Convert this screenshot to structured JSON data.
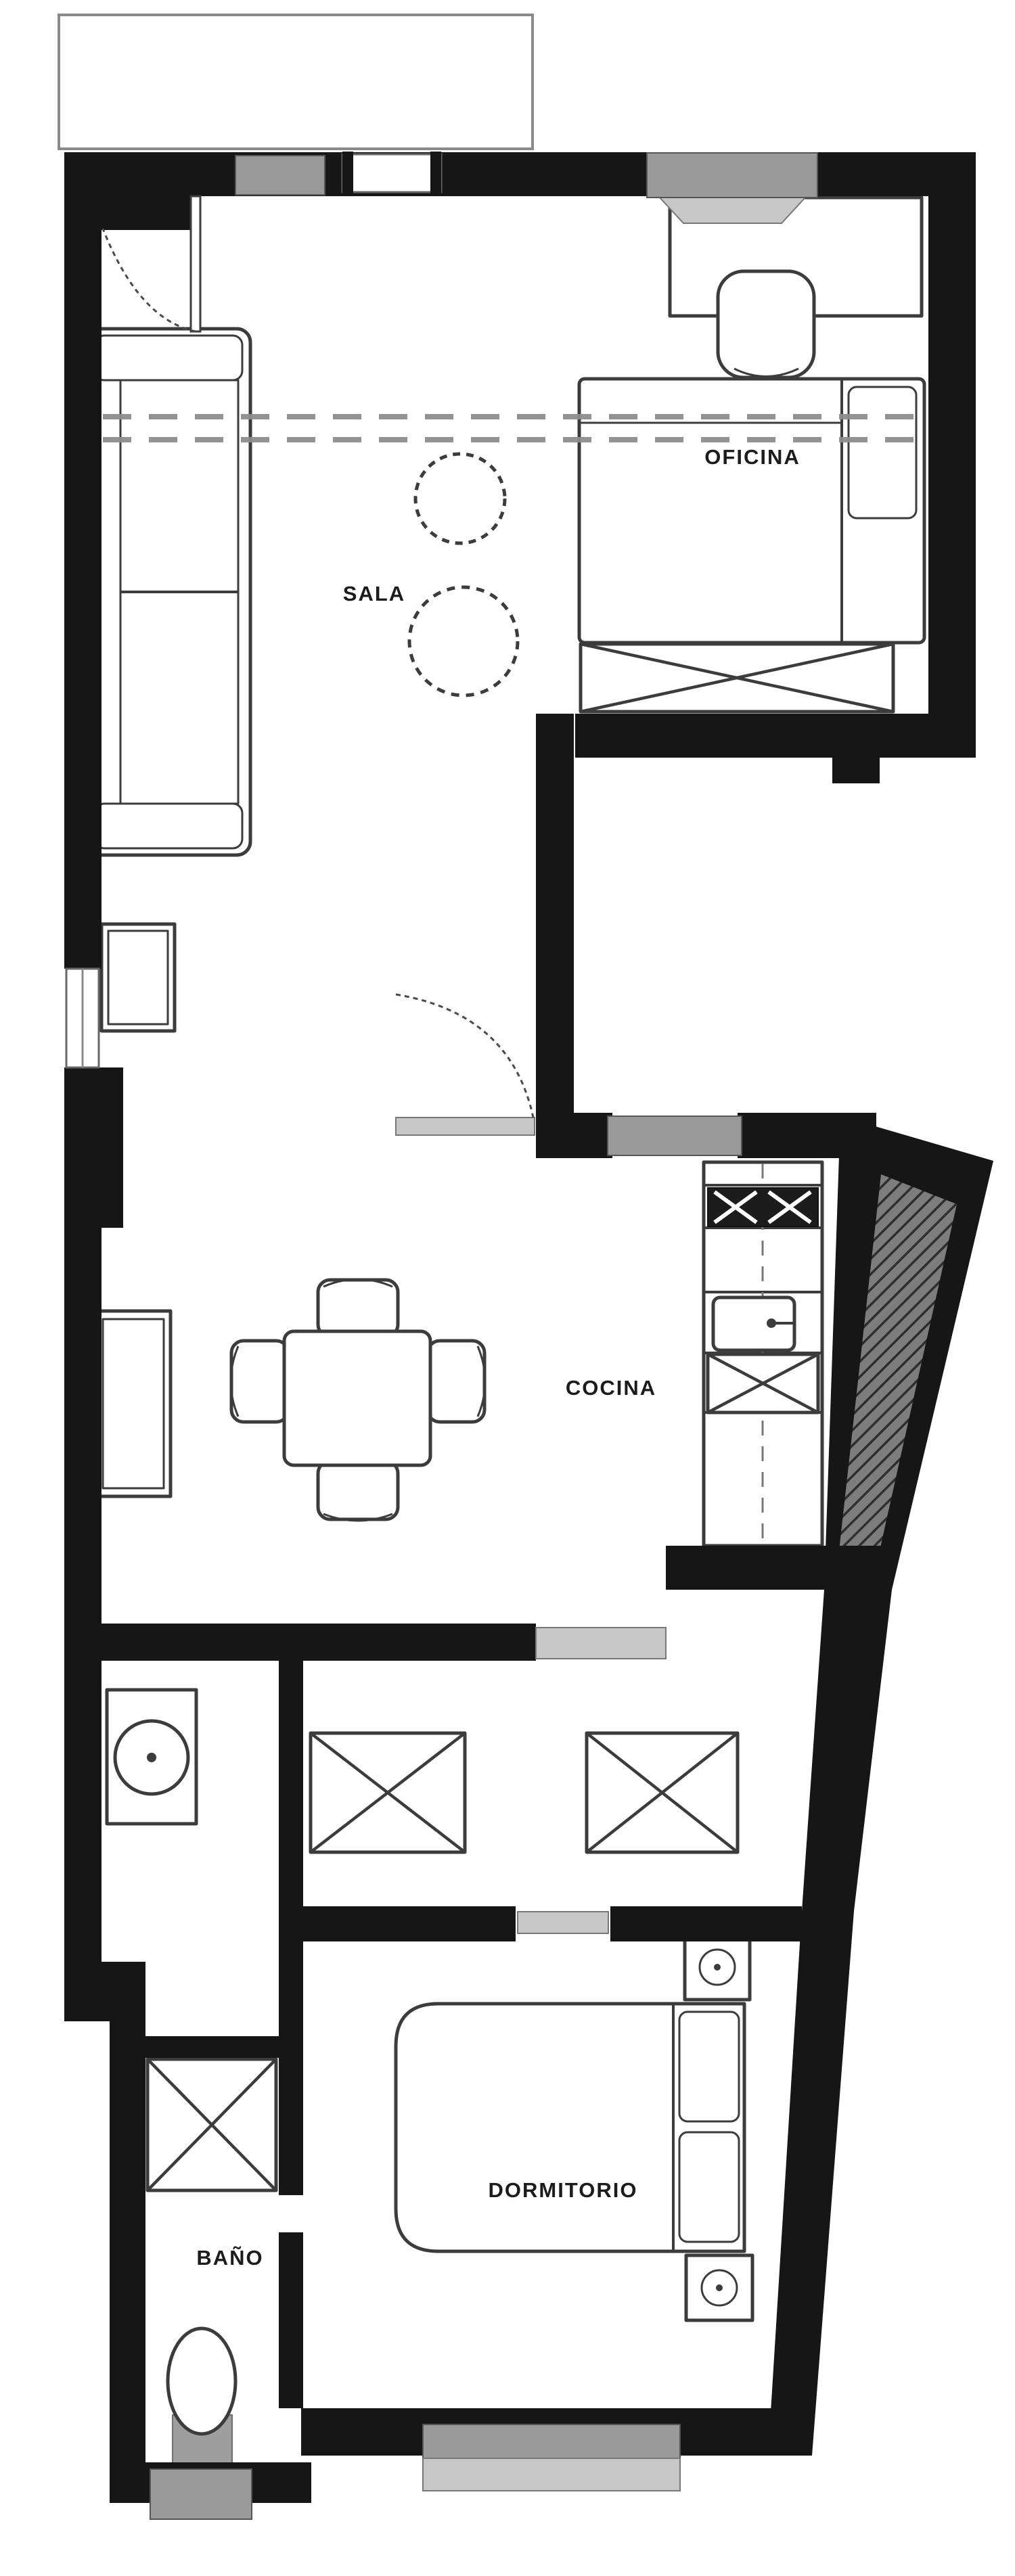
{
  "rooms": {
    "sala": {
      "label": "SALA"
    },
    "oficina": {
      "label": "OFICINA"
    },
    "cocina": {
      "label": "COCINA"
    },
    "dormitorio": {
      "label": "DORMITORIO"
    },
    "bano": {
      "label": "BAÑO"
    }
  },
  "icons": [
    "entry-door-icon",
    "sofa-icon",
    "side-table-icon",
    "plant-circle-icon",
    "desk-icon",
    "office-chair-icon",
    "single-bed-icon",
    "storage-bench-icon",
    "dining-table-icon",
    "dining-chair-icon",
    "sideboard-icon",
    "kitchen-counter-icon",
    "stove-icon",
    "sink-icon",
    "cabinet-x-icon",
    "door-icon",
    "window-icon",
    "washer-icon",
    "wardrobe-x-icon",
    "sliding-door-icon",
    "double-bed-icon",
    "pillow-icon",
    "nightstand-icon",
    "lamp-icon",
    "shower-icon",
    "toilet-icon",
    "section-line",
    "balcony-outline"
  ],
  "colors": {
    "wall": "#161616",
    "line": "#3c3c3c",
    "window": "#9a9a9a",
    "window_light": "#c7c7c7",
    "dash": "#8d8d8d",
    "label": "#1c1c1c",
    "bg": "#ffffff"
  }
}
